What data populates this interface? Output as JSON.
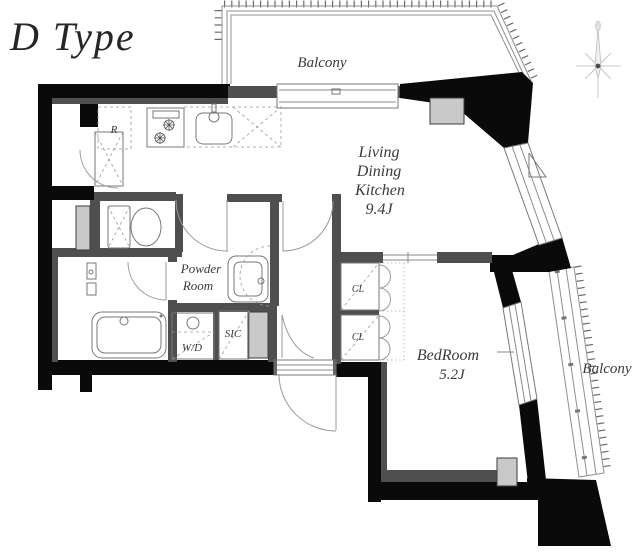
{
  "title": "D Type",
  "labels": {
    "balcony_top": "Balcony",
    "balcony_right": "Balcony",
    "ldk1": "Living",
    "ldk2": "Dining",
    "ldk3": "Kitchen",
    "ldk4": "9.4J",
    "powder1": "Powder",
    "powder2": "Room",
    "bedroom1": "BedRoom",
    "bedroom2": "5.2J",
    "fridge": "R",
    "washer": "W/D",
    "shoes": "SIC",
    "closet1": "CL",
    "closet2": "CL"
  },
  "colors": {
    "exterior_wall": "#0a0a0a",
    "interior_wall": "#4f4f4f",
    "pillar_gray": "#c9c9c9",
    "fixture_line": "#777777",
    "text": "#3a3a3a"
  }
}
